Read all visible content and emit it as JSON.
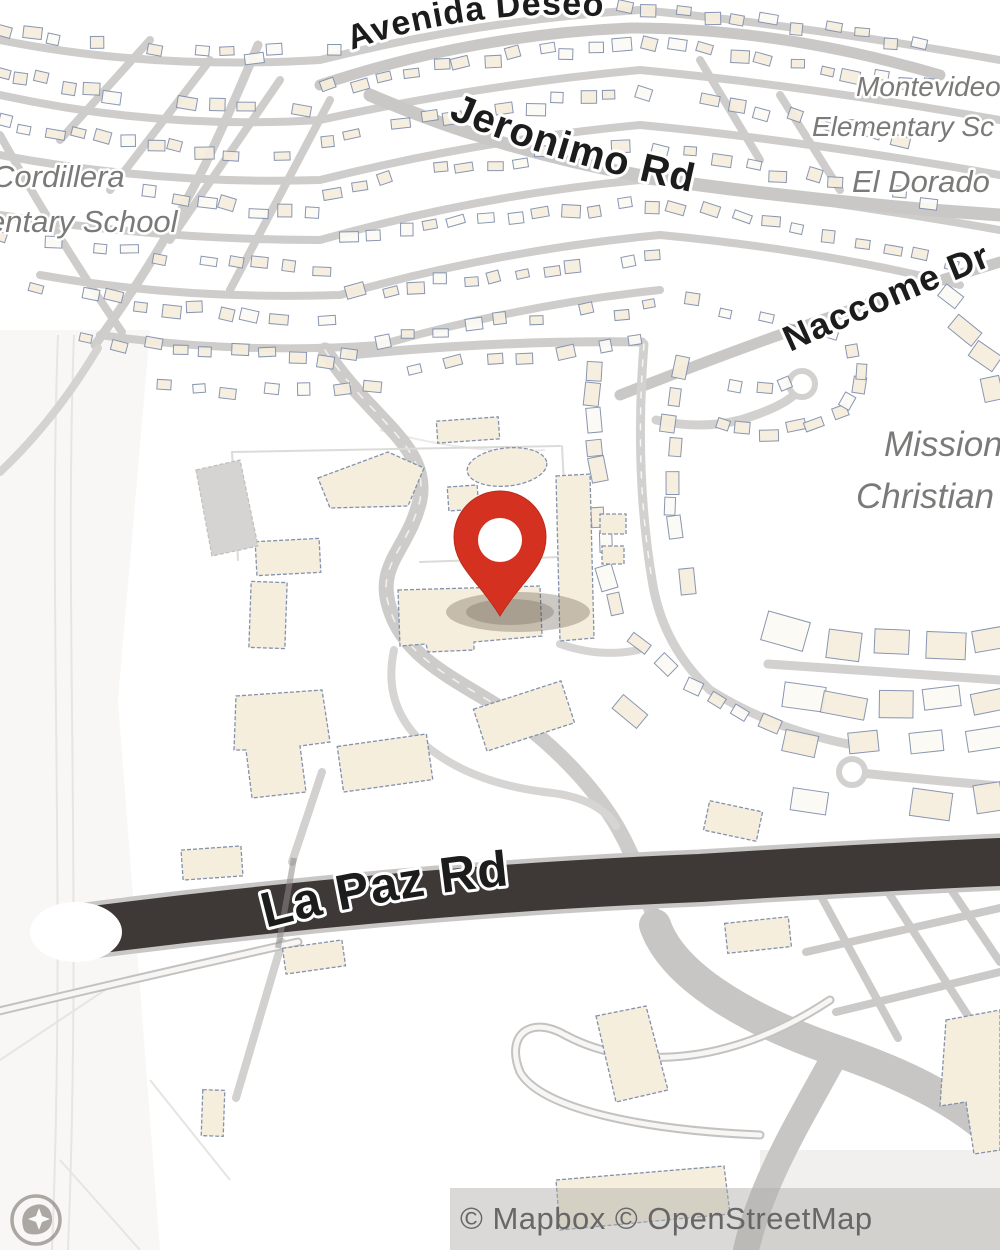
{
  "map": {
    "labels": {
      "roads": {
        "avenida_deseo": "Avenida Deseo",
        "jeronimo_rd": "Jeronimo Rd",
        "naccome": "Naccome Dr",
        "la_paz_rd": "La Paz Rd"
      },
      "pois": {
        "cordillera_line1": "Cordillera",
        "cordillera_line2": "entary School",
        "montevideo_line1": "Montevideo",
        "montevideo_line2": "Elementary Sc",
        "el_dorado": "El Dorado",
        "mission_line1": "Mission",
        "mission_line2": "Christian"
      }
    },
    "marker": {
      "name": "location-pin",
      "color": "#d43120"
    },
    "colors": {
      "background": "#ffffff",
      "road_major_dark": "#3e3936",
      "road_gray": "#cdccca",
      "building_fill": "#f6eedd",
      "building_fill_light": "#fcfaf5",
      "building_stroke": "#8391ad",
      "label_black": "#1c1c1c",
      "label_gray": "#7a7a78",
      "attribution_text": "#676767"
    }
  },
  "attribution": {
    "text": "© Mapbox © OpenStreetMap"
  },
  "logo": {
    "name": "mapbox-logo"
  }
}
